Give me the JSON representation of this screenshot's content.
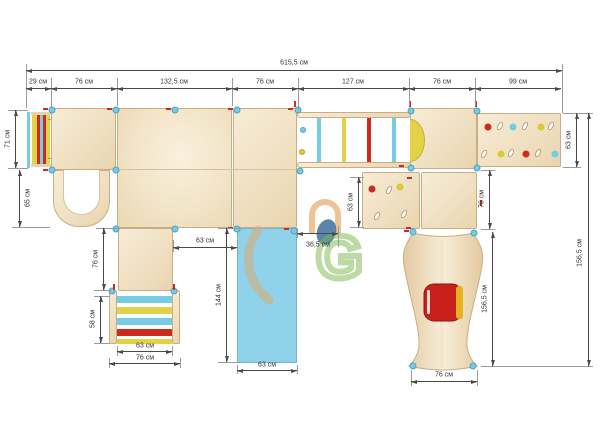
{
  "drawing_title": "playground-top-view-technical-drawing",
  "units": "см",
  "dims": {
    "overall": "615,5 см",
    "seg29": "29 см",
    "seg76a": "76 см",
    "seg132": "132,5 см",
    "seg76b": "76 см",
    "seg127": "127 см",
    "seg76c": "76 см",
    "seg99": "99 см",
    "left71": "71 см",
    "left65": "65 см",
    "leg76": "76 см",
    "left58": "58 см",
    "rung63": "63 см",
    "ladder76": "76 см",
    "gap63": "63 см",
    "slide144": "144 см",
    "slide63": "63 см",
    "mid36": "36,5 см",
    "panel63": "63 см",
    "wall63": "63 см",
    "right76": "76 см",
    "tower156": "156,5 см",
    "tower76": "76 см",
    "height156": "156,5 см"
  },
  "watermark": {
    "letter": "G"
  },
  "colors": {
    "wood": "#F0E0C2",
    "wood-border": "#C9AE85",
    "cyan": "#76CBE5",
    "red": "#CE2A1E",
    "yellow": "#E3D247",
    "slide-blue": "#8FD2EA",
    "dim-line": "#4a4a4a",
    "logo-orange": "#E7A45F",
    "logo-green": "#7CB54A",
    "logo-blue": "#46789E"
  }
}
